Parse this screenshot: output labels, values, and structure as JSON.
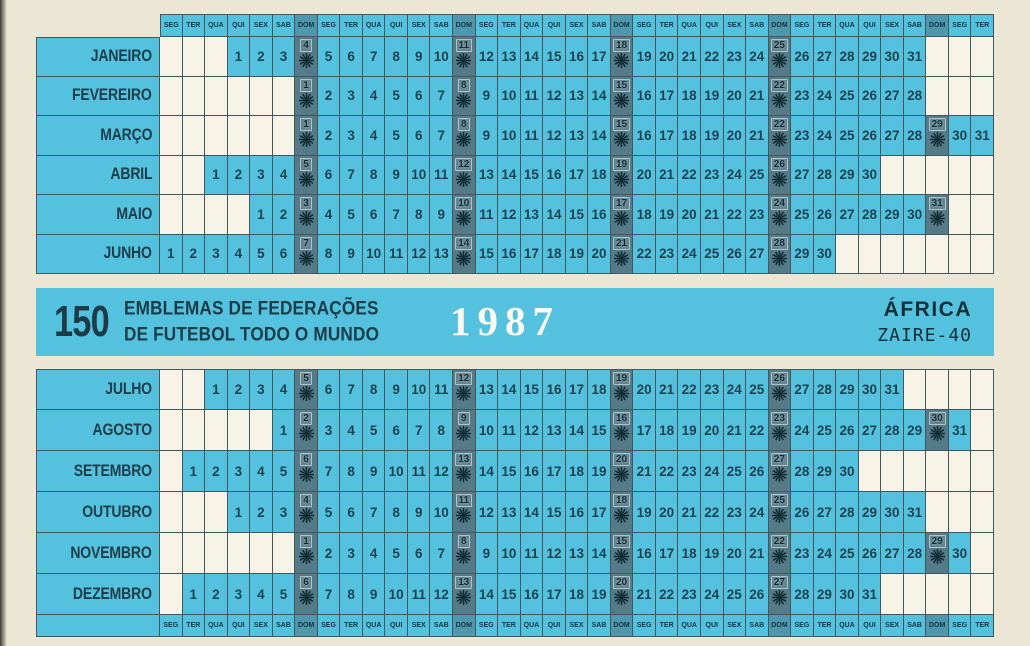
{
  "banner": {
    "number": "150",
    "title_line1": "EMBLEMAS DE FEDERAÇÕES",
    "title_line2": "DE FUTEBOL TODO O MUNDO",
    "year": "1987",
    "region": "ÁFRICA",
    "team": "ZAIRE-40"
  },
  "calendar": {
    "year": 1987,
    "weekdays": [
      "SEG",
      "TER",
      "QUA",
      "QUI",
      "SEX",
      "SAB",
      "DOM"
    ],
    "num_columns": 37,
    "top_months": [
      {
        "name": "JANEIRO",
        "start_col": 3,
        "days": 31,
        "sundays": [
          4,
          11,
          18,
          25
        ]
      },
      {
        "name": "FEVEREIRO",
        "start_col": 6,
        "days": 28,
        "sundays": [
          1,
          8,
          15,
          22
        ]
      },
      {
        "name": "MARÇO",
        "start_col": 6,
        "days": 31,
        "sundays": [
          1,
          8,
          15,
          22,
          29
        ]
      },
      {
        "name": "ABRIL",
        "start_col": 2,
        "days": 30,
        "sundays": [
          5,
          12,
          19,
          26
        ]
      },
      {
        "name": "MAIO",
        "start_col": 4,
        "days": 31,
        "sundays": [
          3,
          10,
          17,
          24,
          31
        ]
      },
      {
        "name": "JUNHO",
        "start_col": 0,
        "days": 30,
        "sundays": [
          7,
          14,
          21,
          28
        ]
      }
    ],
    "bottom_months": [
      {
        "name": "JULHO",
        "start_col": 2,
        "days": 31,
        "sundays": [
          5,
          12,
          19,
          26
        ]
      },
      {
        "name": "AGOSTO",
        "start_col": 5,
        "days": 31,
        "sundays": [
          2,
          9,
          16,
          23,
          30
        ]
      },
      {
        "name": "SETEMBRO",
        "start_col": 1,
        "days": 30,
        "sundays": [
          6,
          13,
          20,
          27
        ]
      },
      {
        "name": "OUTUBRO",
        "start_col": 3,
        "days": 31,
        "sundays": [
          4,
          11,
          18,
          25
        ]
      },
      {
        "name": "NOVEMBRO",
        "start_col": 6,
        "days": 30,
        "sundays": [
          1,
          8,
          15,
          22,
          29
        ]
      },
      {
        "name": "DEZEMBRO",
        "start_col": 1,
        "days": 31,
        "sundays": [
          6,
          13,
          20,
          27
        ]
      }
    ]
  },
  "colors": {
    "paper": "#ece6d4",
    "cell_cyan": "#54c2de",
    "grid_line": "#40595f",
    "blank_cell": "#f7f4e7",
    "number_ink": "#1d4250",
    "sunday_cell": "#567b88",
    "dom_header": "#4f97ac",
    "sun_icon_ink": "#112b33",
    "year_text": "#fbfaf0"
  }
}
